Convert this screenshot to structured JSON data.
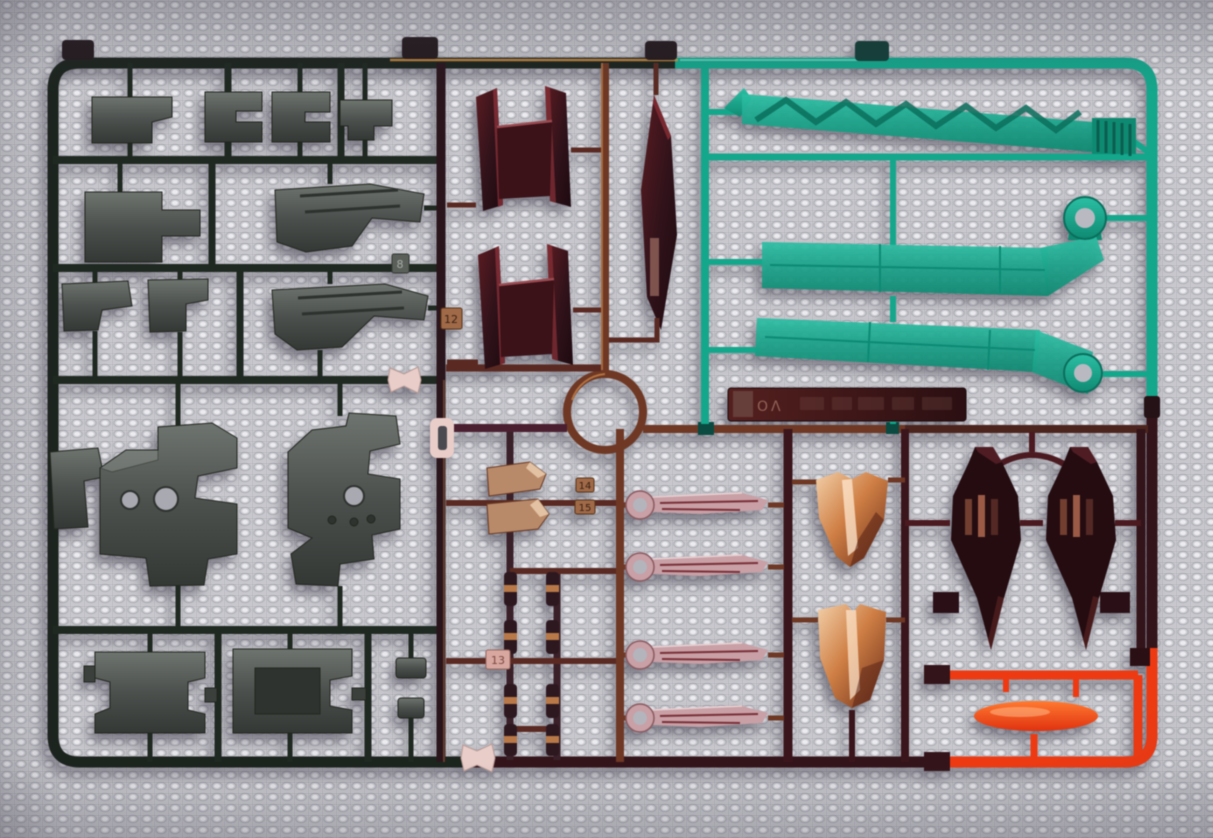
{
  "scene": {
    "subject": "Photograph of a multi-colored plastic model-kit runner (sprue) lying on a textured cloth",
    "background_hex": "#c7c7cc"
  },
  "colors": {
    "frame_dark_green": "#1c241e",
    "frame_copper": "#6e3824",
    "copper_highlight": "#cf8c4e",
    "frame_maroon": "#33141a",
    "runner_dark": "#2a151c",
    "clear_teal": "#14a78c",
    "teal_dark": "#0b6e5c",
    "clear_orange": "#ee3a12",
    "gunmetal": "#575c58",
    "gunmetal_dark": "#3c403d",
    "gunmetal_light": "#9aa09c",
    "metallic_red": "#2e0d12",
    "metallic_red_highlight": "#7a2830",
    "metallic_pink": "#c8a0a6",
    "pink_streak": "#7a3038",
    "polished_copper": "#c87840",
    "clip_pink": "#e9cdc9",
    "tag_copper": "#a06a48"
  },
  "nameplate": {
    "embossed_text": "OΛ"
  },
  "tags": [
    {
      "label": "8"
    },
    {
      "label": "12"
    },
    {
      "label": "13"
    },
    {
      "label": "14"
    },
    {
      "label": "15"
    }
  ],
  "part_groups": [
    {
      "name": "gunmetal-armor-parts",
      "color": "gunmetal",
      "count": 14
    },
    {
      "name": "metallic-red-wing-parts",
      "color": "metallic_red",
      "count": 3
    },
    {
      "name": "clear-teal-blade-parts",
      "color": "clear_teal",
      "count": 3
    },
    {
      "name": "metallic-pink-blade-parts",
      "color": "metallic_pink",
      "count": 4
    },
    {
      "name": "polished-copper-shell-parts",
      "color": "polished_copper",
      "count": 2
    },
    {
      "name": "dark-red-shield-parts",
      "color": "metallic_red",
      "count": 2
    },
    {
      "name": "clear-orange-lens-part",
      "color": "clear_orange",
      "count": 1
    },
    {
      "name": "small-copper-joint-parts",
      "color": "frame_copper",
      "count": 10
    }
  ]
}
